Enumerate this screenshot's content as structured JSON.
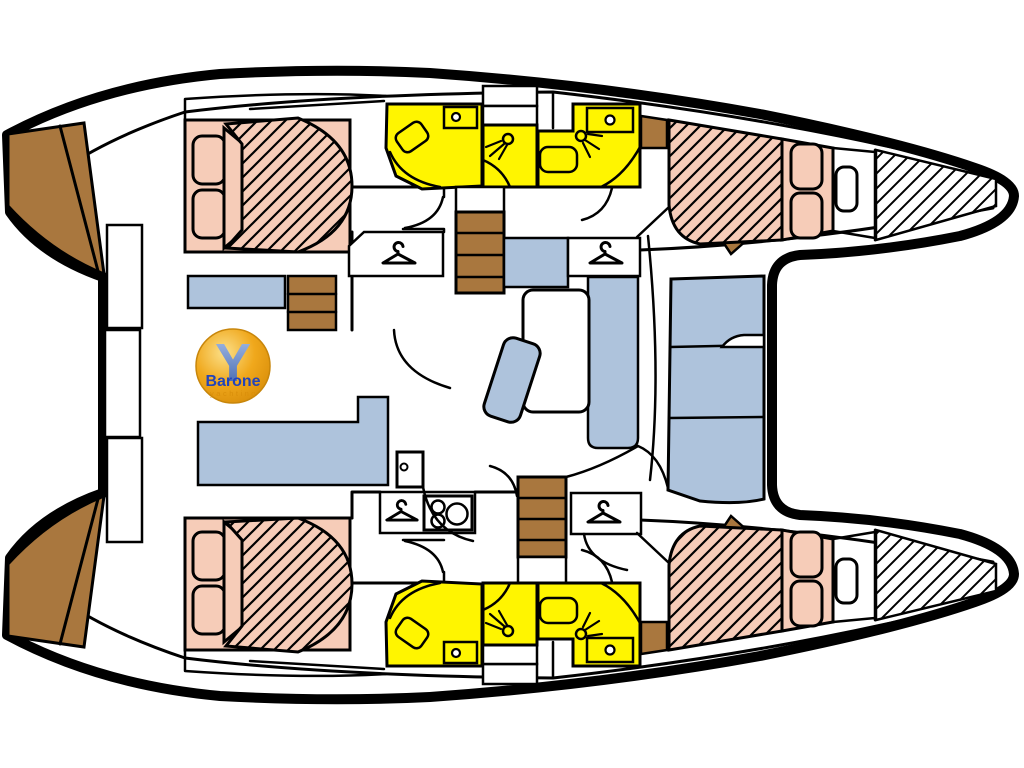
{
  "logo": {
    "monogram": "Y",
    "name": "Barone",
    "tagline": "yachting"
  },
  "colors": {
    "bed": "#F6CCB8",
    "wet_area": "#FFF500",
    "seating": "#AEC3DC",
    "wood": "#A9773E",
    "outline": "#000000",
    "hull_fill": "#FFFFFF",
    "logo_orange": "#F0A81C",
    "logo_orange_dark": "#D98E0A",
    "logo_gold_light": "#FBE08A",
    "logo_blue": "#2244BB",
    "logo_y_light": "#A8C0EA",
    "logo_y_dark": "#3A5EA8"
  },
  "icons": {
    "hanger": "hanger-icon",
    "shower": "shower-head-icon",
    "sink": "sink-icon",
    "toilet": "toilet-icon",
    "door": "door-icon",
    "stove": "stove-burners-icon",
    "steps": "companionway-steps-icon"
  }
}
